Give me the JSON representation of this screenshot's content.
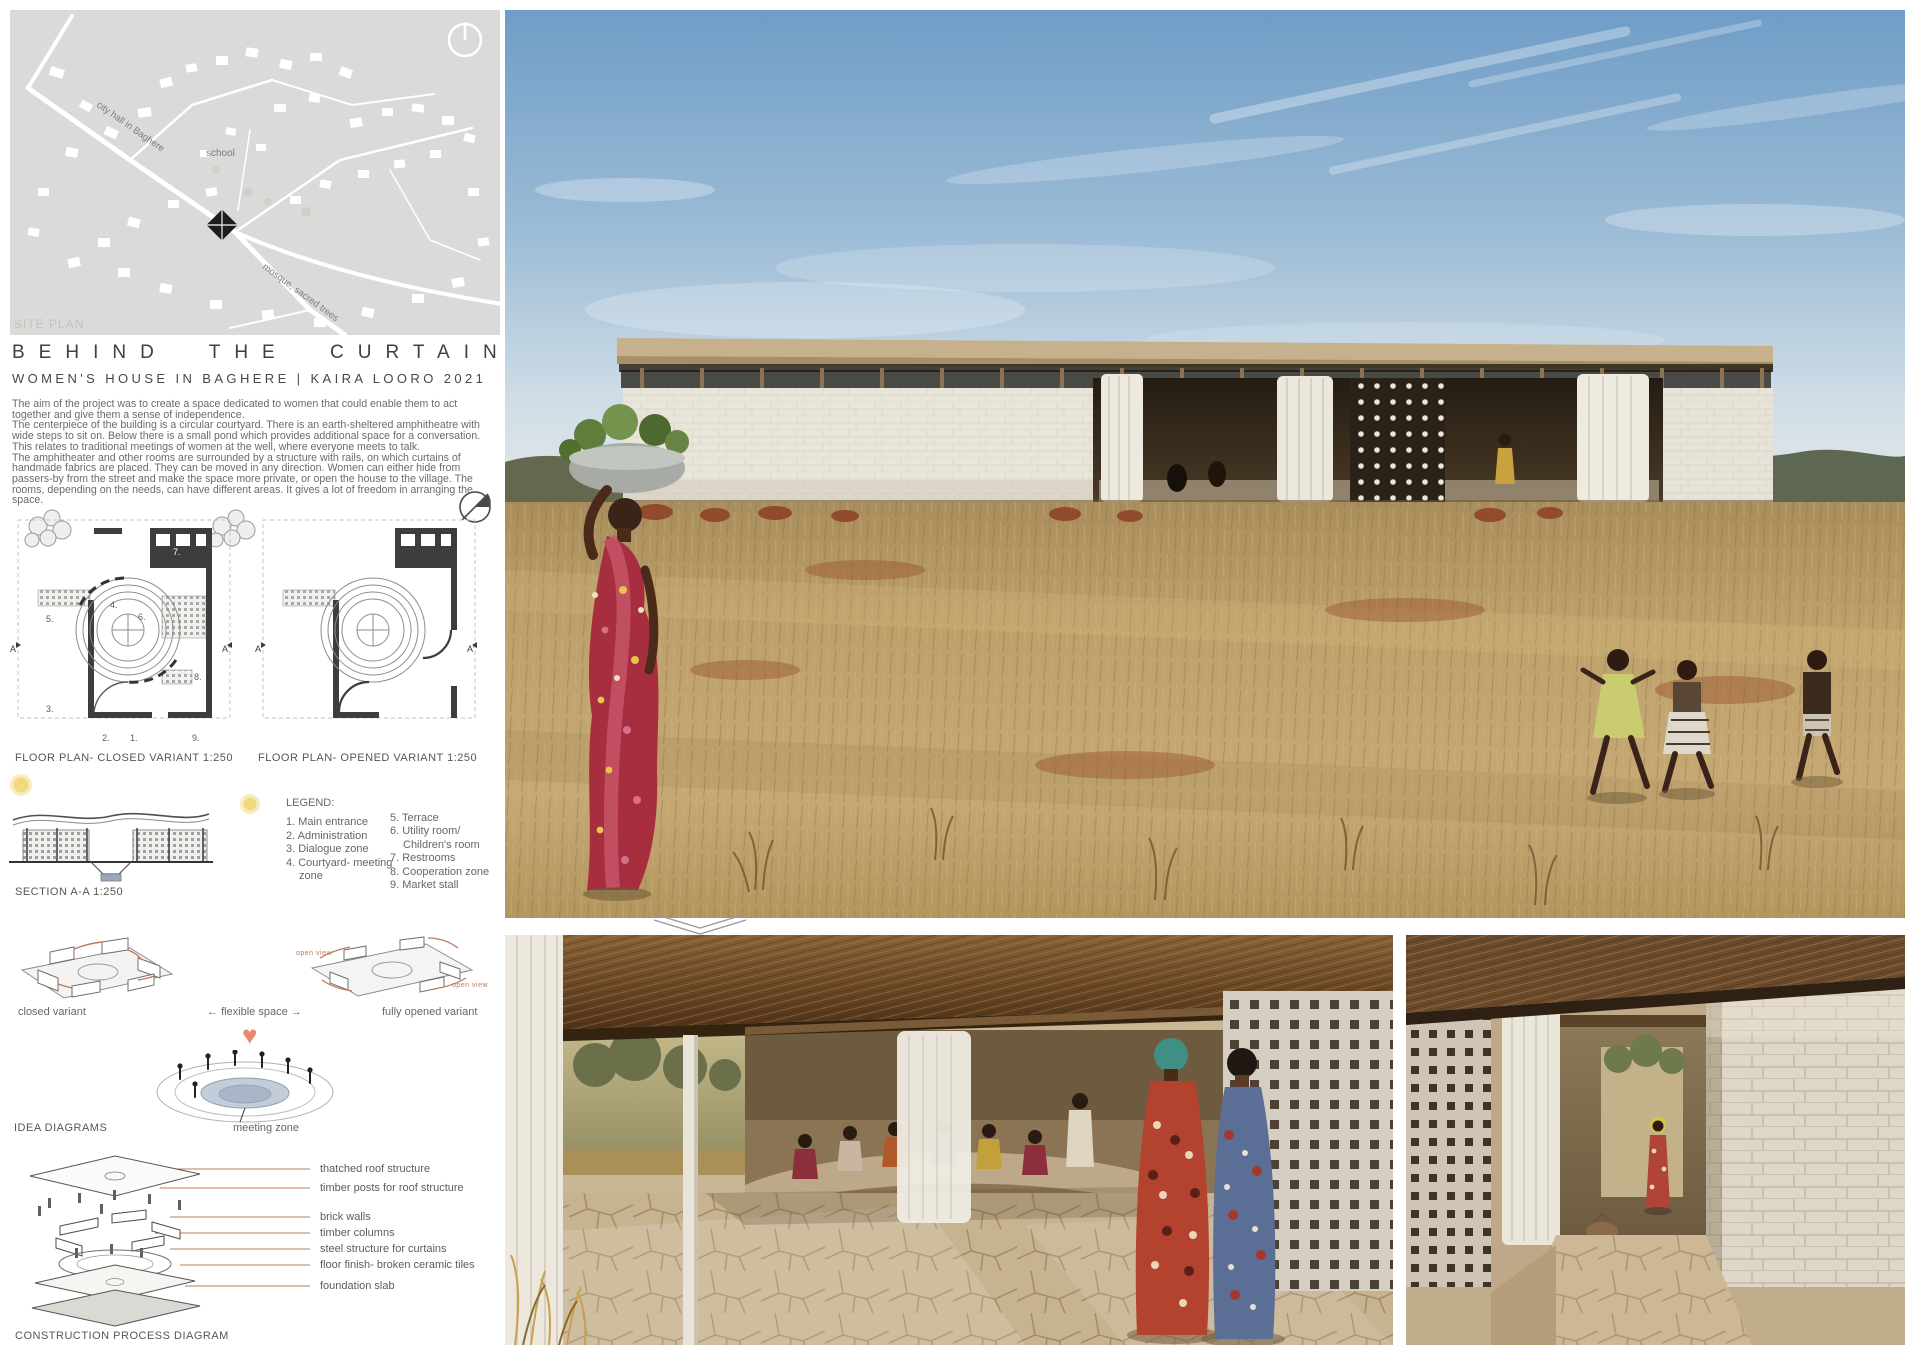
{
  "palette": {
    "accent_salmon": "#c0795b",
    "sun_yellow": "#f1d97e",
    "pond_blue": "#b7c2d1",
    "heart_red": "#e98a70",
    "map_gray": "#dadad8"
  },
  "site_plan": {
    "caption": "SITE PLAN",
    "labels": [
      "city hall in Baghere",
      "school",
      "mosque, sacred trees"
    ]
  },
  "header": {
    "title": "BEHIND THE CURTAIN",
    "subtitle": "WOMEN'S HOUSE IN BAGHERE | KAIRA LOORO 2021"
  },
  "description": {
    "p1": "The aim of the project was to create a space dedicated to women that could enable them to act together and give them a sense of independence.",
    "p2": "The centerpiece of the building is a circular courtyard. There is an earth-sheltered amphitheatre with wide steps to sit on. Below there is a small pond which provides additional space for a conversation. This relates to traditional meetings of women at the well, where everyone meets to talk.",
    "p3": "The amphitheater and other rooms are surrounded by a structure with rails, on which curtains of handmade fabrics are placed. They can be moved in any direction. Women can either hide from passers-by from the street and make the space more private, or open the house to the village. The rooms, depending on the needs, can have different areas. It gives a lot of freedom in arranging the space."
  },
  "floor_plans": {
    "closed_label": "FLOOR PLAN- CLOSED VARIANT  1:250",
    "opened_label": "FLOOR PLAN- OPENED VARIANT  1:250",
    "room_numbers": [
      "1.",
      "2.",
      "3.",
      "4.",
      "5.",
      "6.",
      "7.",
      "8.",
      "9."
    ],
    "markers": [
      "A",
      "A'"
    ]
  },
  "section": {
    "label": "SECTION A-A  1:250"
  },
  "legend": {
    "title": "LEGEND:",
    "left": [
      "1. Main entrance",
      "2. Administration",
      "3. Dialogue zone",
      "4. Courtyard- meeting",
      "zone"
    ],
    "right": [
      "5. Terrace",
      "6. Utility room/",
      "Children's room",
      "7. Restrooms",
      "8. Cooperation zone",
      "9. Market stall"
    ]
  },
  "idea": {
    "heading": "IDEA DIAGRAMS",
    "closed": "closed variant",
    "arrow_left": "←",
    "flexible": "flexible space",
    "arrow_right": "→",
    "opened": "fully opened variant",
    "open_view": "open view",
    "meeting": "meeting zone"
  },
  "construction": {
    "heading": "CONSTRUCTION PROCESS DIAGRAM",
    "labels": [
      "thatched roof structure",
      "timber posts for roof structure",
      "brick walls",
      "timber columns",
      "steel structure for curtains",
      "floor finish- broken ceramic tiles",
      "foundation  slab"
    ]
  }
}
